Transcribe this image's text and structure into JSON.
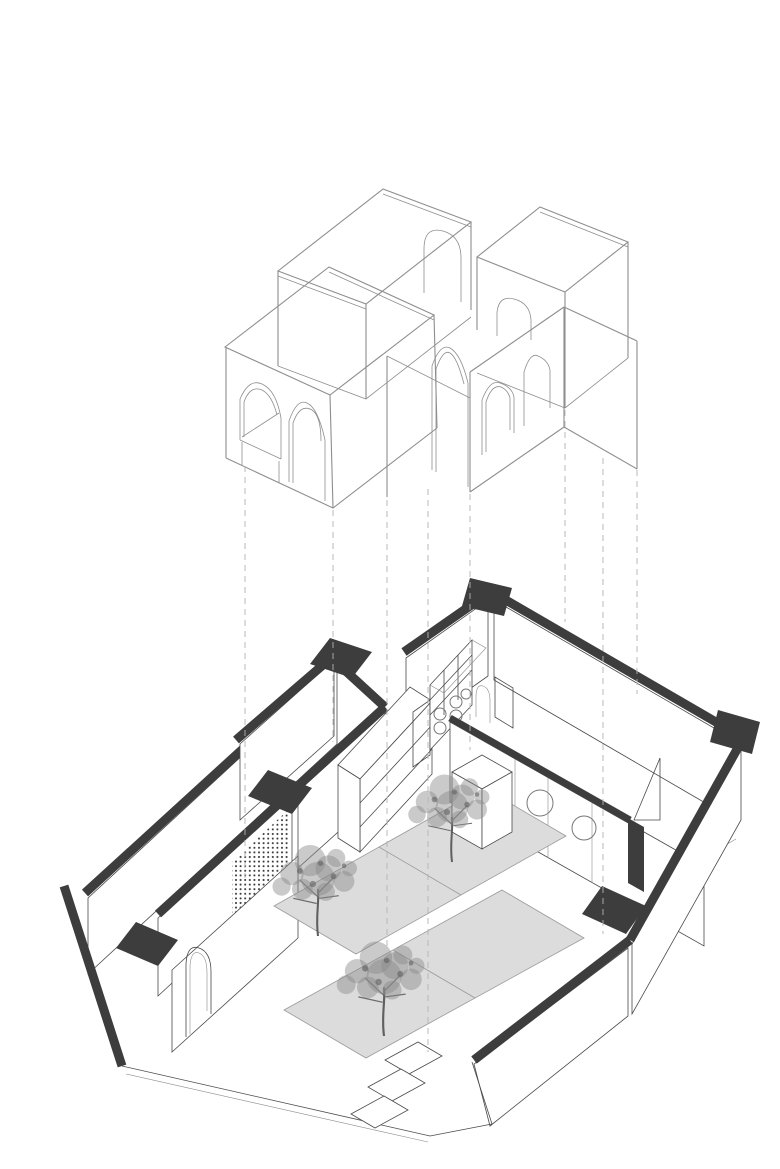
{
  "page": {
    "title": "Exploded axonometric architectural drawing",
    "background": "#ffffff"
  },
  "colors": {
    "background": "#ffffff",
    "wireframe_stroke": "#8e8e8e",
    "dashed_stroke": "#b3b3b3",
    "wall_poche": "#3d3d3d",
    "line": "#4a4a4a",
    "mat_fill": "#dcdcdc",
    "mat_stroke": "#9a9a9a",
    "tree_foliage": "#8a8a8a",
    "tree_trunk": "#5f5f5f",
    "dot_screen": "#3a3a3a"
  },
  "drawing": {
    "style": "exploded axonometric line drawing, lifted wireframe volumes over furnished floor plan",
    "upper_assembly": {
      "wireframe_boxes": 4,
      "window_arches": 1,
      "door_arches": 7
    },
    "projection": {
      "dashed_lines": 8
    },
    "floor_plan": {
      "poche_wall_bands": 10,
      "wall_corner_blocks": 6,
      "perforated_screen_panels": 1,
      "porthole_circles": 3,
      "floor_mats": 4,
      "floor_tiles": 3,
      "trees": 3,
      "display_cubes": 1,
      "shelving_units": 2,
      "arched_doorways": 2,
      "open_door_leaves": 1,
      "glass_door_panels": 2
    }
  }
}
